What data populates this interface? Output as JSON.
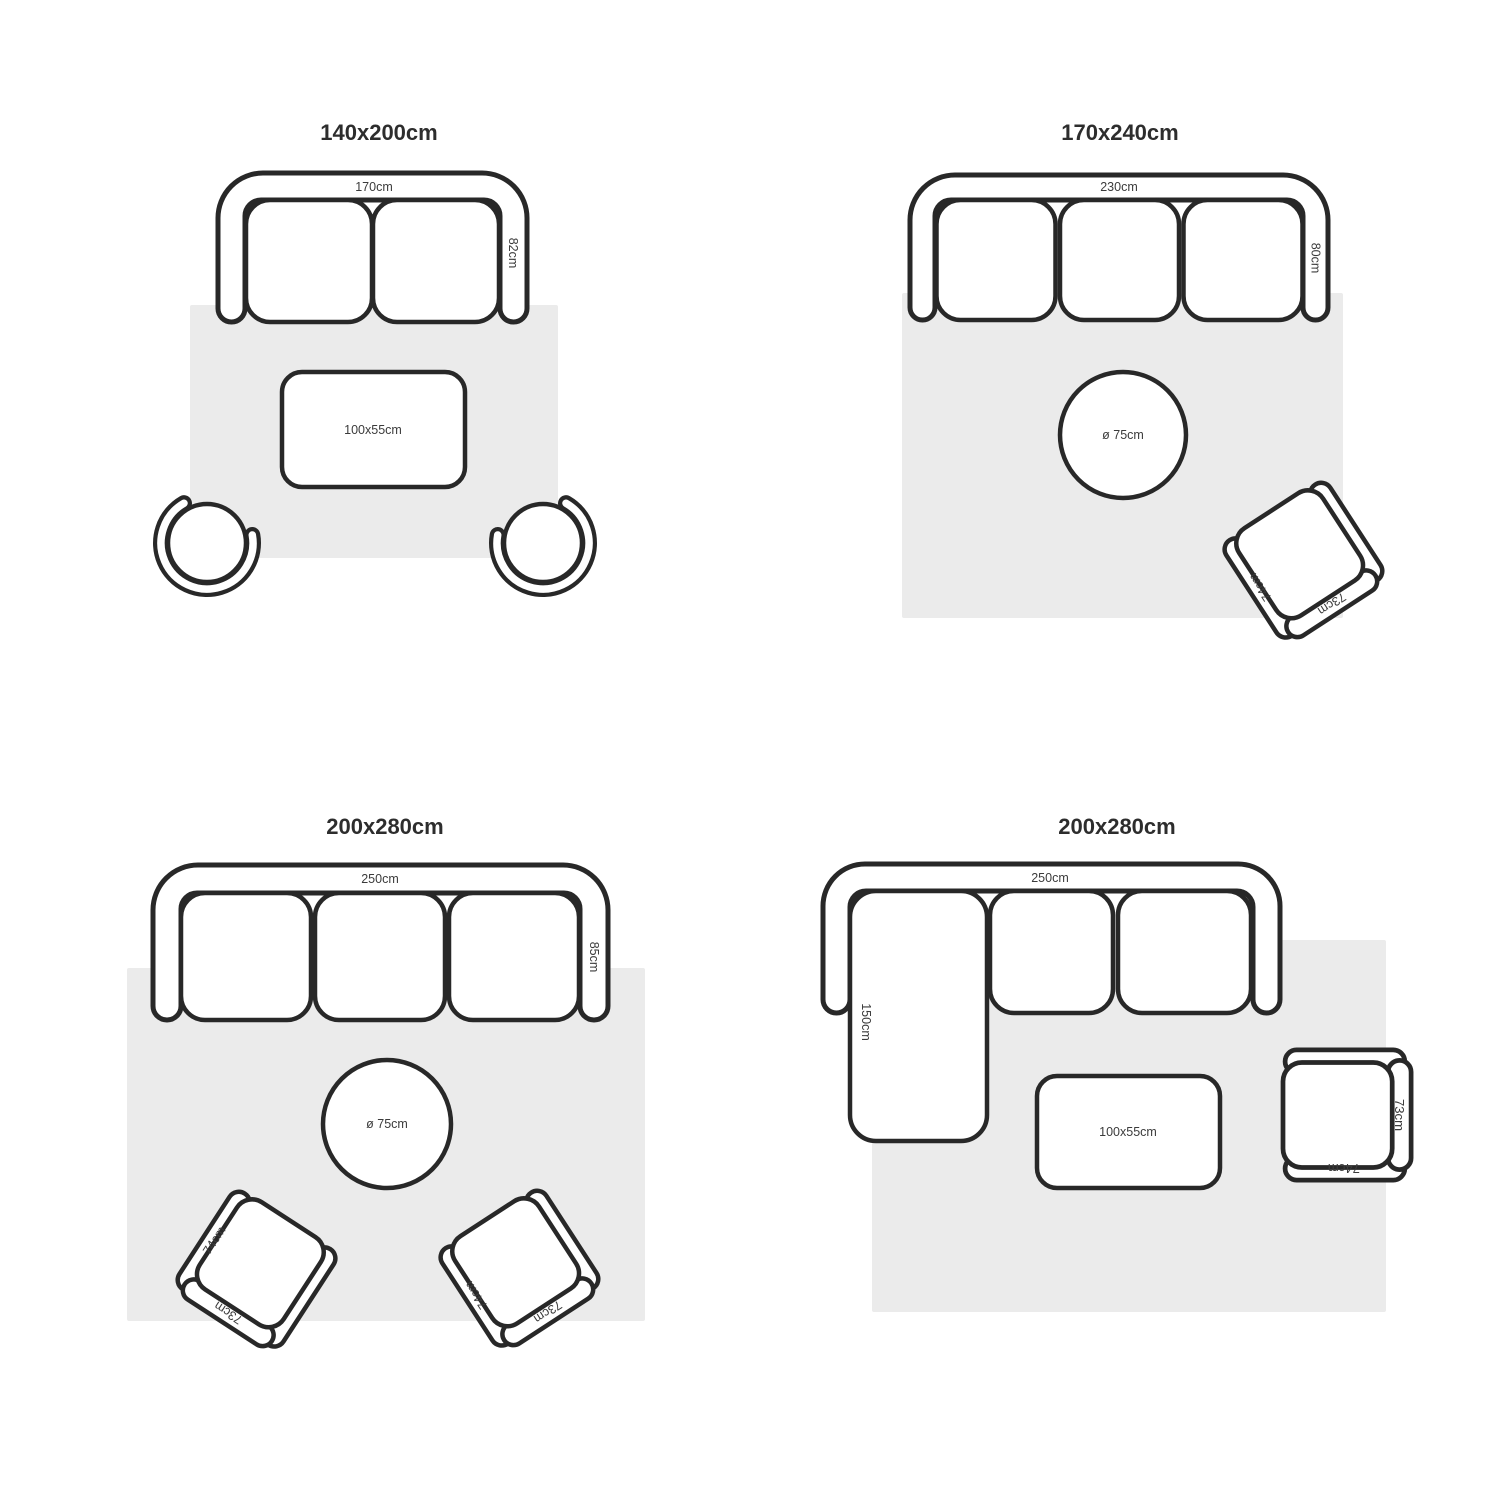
{
  "colors": {
    "background": "#ffffff",
    "outline": "#282828",
    "rug": "#ebebeb",
    "label": "#3b3b3b",
    "title": "#2d2d2d"
  },
  "quadrants": [
    {
      "title": "140x200cm",
      "sofa": {
        "width_label": "170cm",
        "depth_label": "82cm"
      },
      "coffee_table": {
        "label": "100x55cm"
      }
    },
    {
      "title": "170x240cm",
      "sofa": {
        "width_label": "230cm",
        "depth_label": "80cm"
      },
      "side_table": {
        "label": "ø 75cm"
      },
      "chair": {
        "arm_label": "74cm",
        "back_label": "73cm"
      }
    },
    {
      "title": "200x280cm",
      "sofa": {
        "width_label": "250cm",
        "depth_label": "85cm"
      },
      "side_table": {
        "label": "ø 75cm"
      },
      "chairs": [
        {
          "arm_label": "74cm",
          "back_label": "73cm"
        },
        {
          "arm_label": "74cm",
          "back_label": "73cm"
        }
      ]
    },
    {
      "title": "200x280cm",
      "sofa": {
        "width_label": "250cm",
        "chaise_label": "150cm"
      },
      "coffee_table": {
        "label": "100x55cm"
      },
      "chair": {
        "arm_label": "74cm",
        "back_label": "73cm"
      }
    }
  ]
}
